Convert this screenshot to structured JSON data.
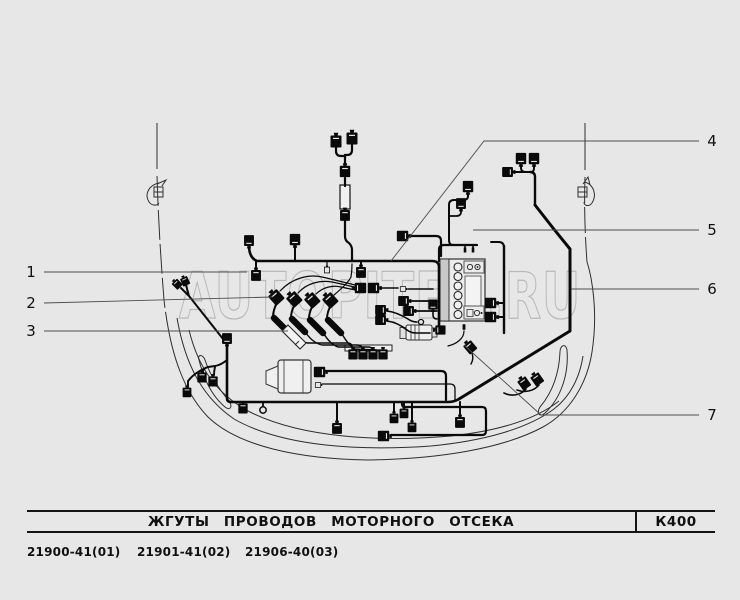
{
  "page": {
    "background": "#e7e7e7",
    "ink": "#0a0a0a",
    "body_line": "#2f2f2f",
    "leader_line": "#4d4d4d",
    "watermark_color": "#b9b9b9"
  },
  "watermark": {
    "text": "AUTOPITER.RU"
  },
  "title_block": {
    "title": "ЖГУТЫ  ПРОВОДОВ  МОТОРНОГО  ОТСЕКА",
    "code": "К400"
  },
  "part_numbers": [
    "21900-41(01)",
    "21901-41(02)",
    "21906-40(03)"
  ],
  "callouts": [
    {
      "label": "1",
      "x": 31,
      "y": 272,
      "leader": [
        [
          44,
          272
        ],
        [
          247,
          272
        ]
      ]
    },
    {
      "label": "2",
      "x": 31,
      "y": 303,
      "leader": [
        [
          44,
          303
        ],
        [
          273,
          297
        ]
      ]
    },
    {
      "label": "3",
      "x": 31,
      "y": 331,
      "leader": [
        [
          44,
          331
        ],
        [
          288,
          331
        ]
      ]
    },
    {
      "label": "4",
      "x": 712,
      "y": 141,
      "leader": [
        [
          699,
          141
        ],
        [
          484,
          141
        ],
        [
          391,
          261
        ]
      ]
    },
    {
      "label": "5",
      "x": 712,
      "y": 230,
      "leader": [
        [
          699,
          230
        ],
        [
          473,
          230
        ]
      ]
    },
    {
      "label": "6",
      "x": 712,
      "y": 289,
      "leader": [
        [
          699,
          289
        ],
        [
          571,
          289
        ]
      ]
    },
    {
      "label": "7",
      "x": 712,
      "y": 415,
      "leader": [
        [
          699,
          415
        ],
        [
          541,
          415
        ],
        [
          464,
          345
        ]
      ]
    }
  ],
  "diagram": {
    "body": [
      {
        "d": "M157,123 V169"
      },
      {
        "d": "M157,176 C158,210 160,250 164,300 Q165,309 166,315",
        "dash": "30 4"
      },
      {
        "d": "M585,123 V170"
      },
      {
        "d": "M585,177 C584,205 585,235 587,262",
        "dash": "26 4"
      },
      {
        "d": "M166,315 C172,356 184,392 208,417 C238,446 298,459 368,460 C438,459 502,449 543,427 C570,412 587,384 592,352 C596,326 595,300 591,278 Q589,268 587,262"
      },
      {
        "d": "M177,318 C185,364 202,397 234,419 C283,447 361,451 431,446 C483,441 527,429 554,409 C571,396 580,376 583,356"
      },
      {
        "d": "M189,330 C198,367 216,394 250,412 C302,438 381,442 451,436 C497,431 535,420 559,401"
      },
      {
        "d": "M199,360 C204,380 212,396 225,407 C230,411 233,407 229,401 C219,389 210,375 205,360 C203,354 197,354 199,360 Z"
      },
      {
        "d": "M567,350 C569,374 561,398 545,413 C540,418 536,413 540,407 C551,394 559,376 560,352 C560,345 566,343 567,350 Z"
      },
      {
        "d": "M154,187 h9 v10 h-9 Z M154,192 h9"
      },
      {
        "d": "M159,183 C149,185 144,194 149,202 C152,206 157,206 159,203"
      },
      {
        "d": "M157,184 L166,180 L162,186"
      },
      {
        "d": "M578,187 h9 v10 h-9 Z M578,192 h9"
      },
      {
        "d": "M585,182 C594,185 597,195 592,203 C589,207 584,206 584,202"
      },
      {
        "d": "M583,184 L588,177 L590,185"
      }
    ],
    "shapes": [
      {
        "t": "rect",
        "x": 440,
        "y": 259,
        "w": 45,
        "h": 62,
        "f": "#ececec",
        "s": "#333",
        "sw": 1.2
      },
      {
        "t": "rect",
        "x": 440,
        "y": 259,
        "w": 9,
        "h": 62,
        "f": "#c9c9c9",
        "s": "#333",
        "sw": 1
      },
      {
        "t": "circle",
        "cx": 458,
        "cy": 267,
        "r": 4,
        "f": "#f0f0f0",
        "s": "#222",
        "sw": 1.1
      },
      {
        "t": "circle",
        "cx": 458,
        "cy": 276.5,
        "r": 4,
        "f": "#f0f0f0",
        "s": "#222",
        "sw": 1.1
      },
      {
        "t": "circle",
        "cx": 458,
        "cy": 286,
        "r": 4,
        "f": "#f0f0f0",
        "s": "#222",
        "sw": 1.1
      },
      {
        "t": "circle",
        "cx": 458,
        "cy": 295.5,
        "r": 4,
        "f": "#f0f0f0",
        "s": "#222",
        "sw": 1.1
      },
      {
        "t": "circle",
        "cx": 458,
        "cy": 305,
        "r": 4,
        "f": "#f0f0f0",
        "s": "#222",
        "sw": 1.1
      },
      {
        "t": "circle",
        "cx": 458,
        "cy": 314.5,
        "r": 4,
        "f": "#f0f0f0",
        "s": "#222",
        "sw": 1.1
      },
      {
        "t": "rect",
        "x": 465,
        "y": 276,
        "w": 16,
        "h": 33,
        "f": "#f3f3f3",
        "s": "#666",
        "sw": 1
      },
      {
        "t": "rect",
        "x": 464,
        "y": 261,
        "w": 20,
        "h": 12,
        "f": "#ececec",
        "s": "#555",
        "sw": 1
      },
      {
        "t": "circle",
        "cx": 470,
        "cy": 267,
        "r": 2.6,
        "f": "none",
        "s": "#333",
        "sw": 1
      },
      {
        "t": "circle",
        "cx": 477.5,
        "cy": 267,
        "r": 2.6,
        "f": "none",
        "s": "#333",
        "sw": 1
      },
      {
        "t": "circle",
        "cx": 477.5,
        "cy": 267,
        "r": 0.9,
        "f": "#111"
      },
      {
        "t": "rect",
        "x": 464,
        "y": 306,
        "w": 20,
        "h": 13,
        "f": "#ececec",
        "s": "#555",
        "sw": 1
      },
      {
        "t": "rect",
        "x": 467,
        "y": 309.5,
        "w": 6,
        "h": 7,
        "f": "none",
        "s": "#555",
        "sw": 1
      },
      {
        "t": "circle",
        "cx": 477,
        "cy": 313,
        "r": 2.6,
        "f": "none",
        "s": "#333",
        "sw": 1
      },
      {
        "t": "circle",
        "cx": 481.5,
        "cy": 313,
        "r": 1,
        "f": "#111"
      },
      {
        "t": "rect",
        "x": 340,
        "y": 185,
        "w": 10,
        "h": 24,
        "f": "#f0f0f0",
        "s": "#111",
        "sw": 1.2
      },
      {
        "t": "rect",
        "x": 345,
        "y": 345,
        "w": 47,
        "h": 6,
        "f": "#f0f0f0",
        "s": "#222",
        "sw": 1
      },
      {
        "t": "rect",
        "x": 278,
        "y": 360,
        "w": 33,
        "h": 33,
        "rx": 3,
        "f": "#f0f0f0",
        "s": "#333",
        "sw": 1.2
      },
      {
        "t": "path",
        "d": "M266,371 L278,366 L278,389 L266,384 Z",
        "f": "#f0f0f0",
        "s": "#333",
        "sw": 1
      },
      {
        "t": "path",
        "d": "M284,360 V393 M303,360 V393",
        "f": "none",
        "s": "#333",
        "sw": 0.8
      },
      {
        "t": "rect",
        "x": 406,
        "y": 325,
        "w": 26,
        "h": 15,
        "rx": 2,
        "f": "#efefef",
        "s": "#333",
        "sw": 1.1
      },
      {
        "t": "rect",
        "x": 400,
        "y": 327.5,
        "w": 6,
        "h": 11,
        "f": "#e0e0e0",
        "s": "#333",
        "sw": 0.9
      },
      {
        "t": "rect",
        "x": 432,
        "y": 328,
        "w": 5,
        "h": 9,
        "f": "#e0e0e0",
        "s": "#333",
        "sw": 0.9
      },
      {
        "t": "path",
        "d": "M411,325 V340 M415,325 V340 M419,325 V340",
        "f": "none",
        "s": "#333",
        "sw": 0.8
      },
      {
        "t": "path",
        "d": "M282,331 L288,325 L306,343 L300,349 Z",
        "f": "#f2f2f2",
        "s": "#222",
        "sw": 1.1,
        "layer": "over"
      },
      {
        "t": "path",
        "d": "M299,341 L295,345",
        "f": "none",
        "s": "#222",
        "sw": 0.9,
        "layer": "over"
      }
    ],
    "harness": [
      {
        "d": "M336,146 V151 Q336,156 341,156 H345",
        "w": 2.2
      },
      {
        "d": "M352,143 V150 Q352,155 347,155 H345",
        "w": 2.2
      },
      {
        "d": "M345,155 V165",
        "w": 2.2
      },
      {
        "d": "M345,178 V186",
        "w": 2.2
      },
      {
        "d": "M345,221 V236 Q345,241 349,243 Q352,246 352,250 V261",
        "w": 2.2
      },
      {
        "d": "M249,245 Q249,258 257,261 L432,261 Q439,261 439,267 V331",
        "w": 2.6
      },
      {
        "d": "M439,261 V250 Q439,245 444,245 H477",
        "w": 2.2
      },
      {
        "d": "M465,245 V248 M473,245 V248",
        "w": 1.6
      },
      {
        "d": "M409,236 H436 Q441,236 441,241 V256",
        "w": 2.2
      },
      {
        "d": "M468,193 V196 Q468,200 463,200 H454 Q449,200 449,205 V240 Q449,245 453,245",
        "w": 2
      },
      {
        "d": "M461,210 V212 Q461,216 456,216 H449",
        "w": 1.8
      },
      {
        "d": "M521,165 V168 Q521,172 526,172 H530",
        "w": 2
      },
      {
        "d": "M534,165 V168 Q534,172 531,172",
        "w": 2
      },
      {
        "d": "M513,172 H526",
        "w": 2
      },
      {
        "d": "M530,172 Q535,172 535,177 V205",
        "w": 2.4
      },
      {
        "d": "M535,205 L553,228 L570,249 V331 L459,399",
        "w": 3
      },
      {
        "d": "M459,399 Q454,402 448,402 H231 Q227,402 227,398 V344",
        "w": 2.6
      },
      {
        "d": "M227,344 L189,296 M189,296 L181,288 M189,296 L186,285",
        "w": 2
      },
      {
        "d": "M227,360 Q221,365 215,366 L208,367 M208,367 Q203,368 203,372 V373 M215,367 Q214,371 214,375 M208,367 Q195,372 188,381 V387",
        "w": 1.9
      },
      {
        "d": "M243,402 V404 M263,402 V406",
        "w": 1.8
      },
      {
        "d": "M295,246 V261 M256,261 V270 M361,261 V266",
        "w": 2
      },
      {
        "d": "M327,261 V265",
        "w": 1.2
      },
      {
        "d": "M324,371 H441 Q446,371 446,376 V400",
        "w": 2.2
      },
      {
        "d": "M322,384 H450 Q455,384 455,389 V400",
        "w": 1.3
      },
      {
        "d": "M274,318 L287,331",
        "w": 6.5
      },
      {
        "d": "M292,319 L305,332",
        "w": 6.5
      },
      {
        "d": "M310,320 L323,333",
        "w": 6.5
      },
      {
        "d": "M328,320 L341,333",
        "w": 6.5
      },
      {
        "d": "M277,303 Q273,310 273,317",
        "w": 2
      },
      {
        "d": "M295,304 Q291,311 291,318",
        "w": 2
      },
      {
        "d": "M313,305 Q309,312 309,319",
        "w": 2
      },
      {
        "d": "M331,305 Q327,312 327,319",
        "w": 2
      },
      {
        "d": "M288,332 Q297,342 308,343 L347,343 Q352,343 352,347 V349",
        "w": 1.4
      },
      {
        "d": "M306,333 Q313,343 322,345 L357,345 Q362,345 362,349",
        "w": 1.4
      },
      {
        "d": "M324,334 Q330,344 338,347 H367 Q372,347 372,349",
        "w": 1.4
      },
      {
        "d": "M342,334 Q347,343 354,349 L377,350 Q382,350 382,351",
        "w": 1.4
      },
      {
        "d": "M280,291 C292,278 309,274 322,277 C335,280 347,283 355,285",
        "w": 1.2
      },
      {
        "d": "M298,293 C307,283 320,280 332,282 C342,284 351,286 356,288",
        "w": 1.2
      },
      {
        "d": "M316,294 C323,287 333,285 341,287 Q350,289 356,290",
        "w": 1.2
      },
      {
        "d": "M334,295 C341,289 348,283 351,277 Q352,271 352,264",
        "w": 1.2
      },
      {
        "d": "M380,288 H398 M408,289 H433",
        "w": 1.6
      },
      {
        "d": "M410,301 H437 M413,311 H437",
        "w": 1.8
      },
      {
        "d": "M387,311 C396,312 403,316 408,319 Q412,322 417,322",
        "w": 1.6
      },
      {
        "d": "M387,321 C396,322 402,326 407,330 Q411,333 416,333 H430",
        "w": 1.6
      },
      {
        "d": "M433,311 V315 Q433,319 437,319",
        "w": 1.6
      },
      {
        "d": "M464,331 C464,339 456,344 448,346",
        "w": 1.2
      },
      {
        "d": "M497,303 H504 M497,317 H504",
        "w": 2
      },
      {
        "d": "M504,246 V333",
        "w": 2.4
      },
      {
        "d": "M504,248 Q504,242 499,242 H491",
        "w": 2
      },
      {
        "d": "M526,389 C521,395 512,397 504,393",
        "w": 1.6
      },
      {
        "d": "M539,385 C534,391 525,393 517,390",
        "w": 1.6
      },
      {
        "d": "M472,353 Q474,359 471,364",
        "w": 1.4
      },
      {
        "d": "M402,402 V404 Q402,407 406,407 H482 Q486,407 486,411 V431 Q486,435 482,435 H391",
        "w": 2.2
      },
      {
        "d": "M394,402 V412 M412,402 V420 M337,402 V422 M460,402 V416 M404,402 V407",
        "w": 2
      }
    ],
    "connectors": [
      [
        336,
        141,
        0,
        1,
        "b"
      ],
      [
        352,
        138,
        0,
        1,
        "b"
      ],
      [
        345,
        171,
        0,
        0.95,
        "b"
      ],
      [
        345,
        215,
        0,
        0.9,
        "b"
      ],
      [
        403,
        236,
        90,
        0.95,
        "b"
      ],
      [
        468,
        187,
        180,
        0.95,
        "b"
      ],
      [
        461,
        204,
        180,
        0.9,
        "b"
      ],
      [
        521,
        159,
        180,
        0.95,
        "b"
      ],
      [
        534,
        159,
        180,
        0.95,
        "b"
      ],
      [
        508,
        172,
        90,
        0.9,
        "b"
      ],
      [
        295,
        240,
        180,
        0.95,
        "b"
      ],
      [
        249,
        241,
        180,
        0.9,
        "b"
      ],
      [
        256,
        275,
        0,
        0.9,
        "b"
      ],
      [
        361,
        272,
        0,
        0.9,
        "b"
      ],
      [
        327,
        270,
        0,
        0.65,
        "w"
      ],
      [
        360,
        288,
        270,
        0.95,
        "b"
      ],
      [
        374,
        288,
        90,
        0.95,
        "b"
      ],
      [
        403,
        289,
        90,
        0.6,
        "w"
      ],
      [
        177,
        284,
        -45,
        0.7,
        "b"
      ],
      [
        185,
        281,
        -25,
        0.7,
        "b"
      ],
      [
        227,
        339,
        180,
        0.9,
        "b"
      ],
      [
        202,
        377,
        0,
        0.85,
        "b"
      ],
      [
        213,
        381,
        0,
        0.85,
        "b"
      ],
      [
        187,
        392,
        0,
        0.8,
        "b"
      ],
      [
        243,
        408,
        0,
        0.85,
        "b"
      ],
      [
        263,
        410,
        0,
        1,
        "r"
      ],
      [
        320,
        372,
        90,
        0.95,
        "b"
      ],
      [
        318,
        385,
        90,
        0.6,
        "w"
      ],
      [
        276,
        297,
        -42,
        1.05,
        "b"
      ],
      [
        294,
        299,
        -42,
        1.05,
        "b"
      ],
      [
        312,
        300,
        -42,
        1.05,
        "b"
      ],
      [
        330,
        300,
        -42,
        1.05,
        "b"
      ],
      [
        353,
        354,
        0,
        0.85,
        "b"
      ],
      [
        363,
        354,
        0,
        0.85,
        "b"
      ],
      [
        373,
        354,
        0,
        0.85,
        "b"
      ],
      [
        383,
        354,
        0,
        0.85,
        "b"
      ],
      [
        404,
        301,
        90,
        0.9,
        "b"
      ],
      [
        409,
        311,
        90,
        0.9,
        "b"
      ],
      [
        381,
        310,
        90,
        0.9,
        "b"
      ],
      [
        381,
        320,
        90,
        0.9,
        "b"
      ],
      [
        433,
        305,
        180,
        0.85,
        "b"
      ],
      [
        421,
        322,
        0,
        0.8,
        "r"
      ],
      [
        440,
        330,
        270,
        0.85,
        "b"
      ],
      [
        464,
        327,
        0,
        0.55,
        "p"
      ],
      [
        465,
        250,
        180,
        0.5,
        "p"
      ],
      [
        473,
        250,
        180,
        0.5,
        "p"
      ],
      [
        491,
        303,
        90,
        0.95,
        "b"
      ],
      [
        491,
        317,
        90,
        0.95,
        "b"
      ],
      [
        524,
        383,
        -35,
        0.9,
        "b"
      ],
      [
        537,
        379,
        -35,
        0.9,
        "b"
      ],
      [
        470,
        347,
        -40,
        0.9,
        "b"
      ],
      [
        337,
        428,
        0,
        0.9,
        "b"
      ],
      [
        394,
        418,
        0,
        0.8,
        "b"
      ],
      [
        412,
        427,
        0,
        0.8,
        "b"
      ],
      [
        460,
        422,
        0,
        0.9,
        "b"
      ],
      [
        384,
        436,
        90,
        0.95,
        "b"
      ],
      [
        404,
        413,
        0,
        0.8,
        "b"
      ]
    ]
  }
}
